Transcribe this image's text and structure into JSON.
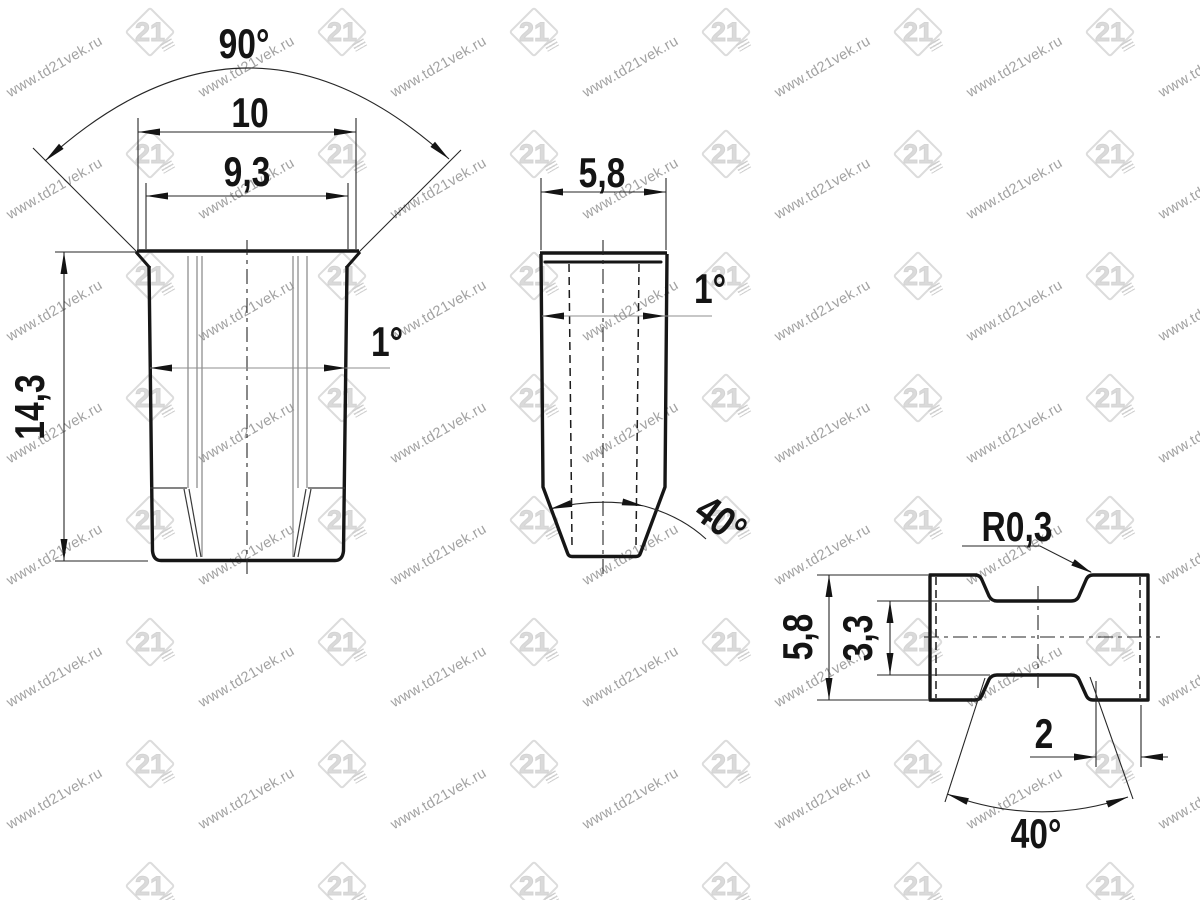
{
  "watermark": {
    "text": "www.td21vek.ru",
    "logo_text": "21",
    "text_color": "#a2a2a2",
    "logo_color": "#d9d9d9"
  },
  "colors": {
    "line": "#161616",
    "thin": "#262626",
    "gray": "#8f8f8f",
    "background": "#ffffff"
  },
  "views": {
    "front": {
      "dims": {
        "countersink_angle": "90°",
        "flange_width": "10",
        "body_width": "9,3",
        "height": "14,3",
        "taper_angle": "1°"
      }
    },
    "side": {
      "dims": {
        "width": "5,8",
        "taper_angle": "1°",
        "tip_angle": "40°"
      }
    },
    "bottom": {
      "dims": {
        "fillet_radius": "R0,3",
        "height": "5,8",
        "waist_height": "3,3",
        "chamfer_width": "2",
        "notch_angle": "40°"
      }
    }
  }
}
